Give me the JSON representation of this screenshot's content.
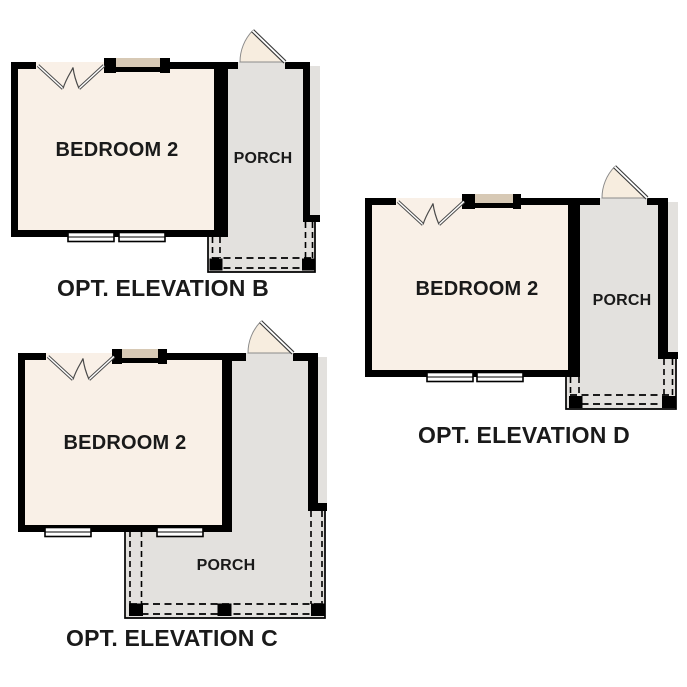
{
  "colors": {
    "background": "#ffffff",
    "wall": "#000000",
    "bedroom_fill": "#f9f0e7",
    "porch_fill": "#e3e1de",
    "accent_tan": "#d7c9b5",
    "door_fill": "#f7eddf",
    "line_gray": "#4a4a4a",
    "label_text": "#1a1a1a"
  },
  "plans": {
    "b": {
      "room_label": "BEDROOM 2",
      "porch_label": "PORCH",
      "caption": "OPT. ELEVATION B"
    },
    "c": {
      "room_label": "BEDROOM 2",
      "porch_label": "PORCH",
      "caption": "OPT. ELEVATION C"
    },
    "d": {
      "room_label": "BEDROOM 2",
      "porch_label": "PORCH",
      "caption": "OPT. ELEVATION D"
    }
  }
}
